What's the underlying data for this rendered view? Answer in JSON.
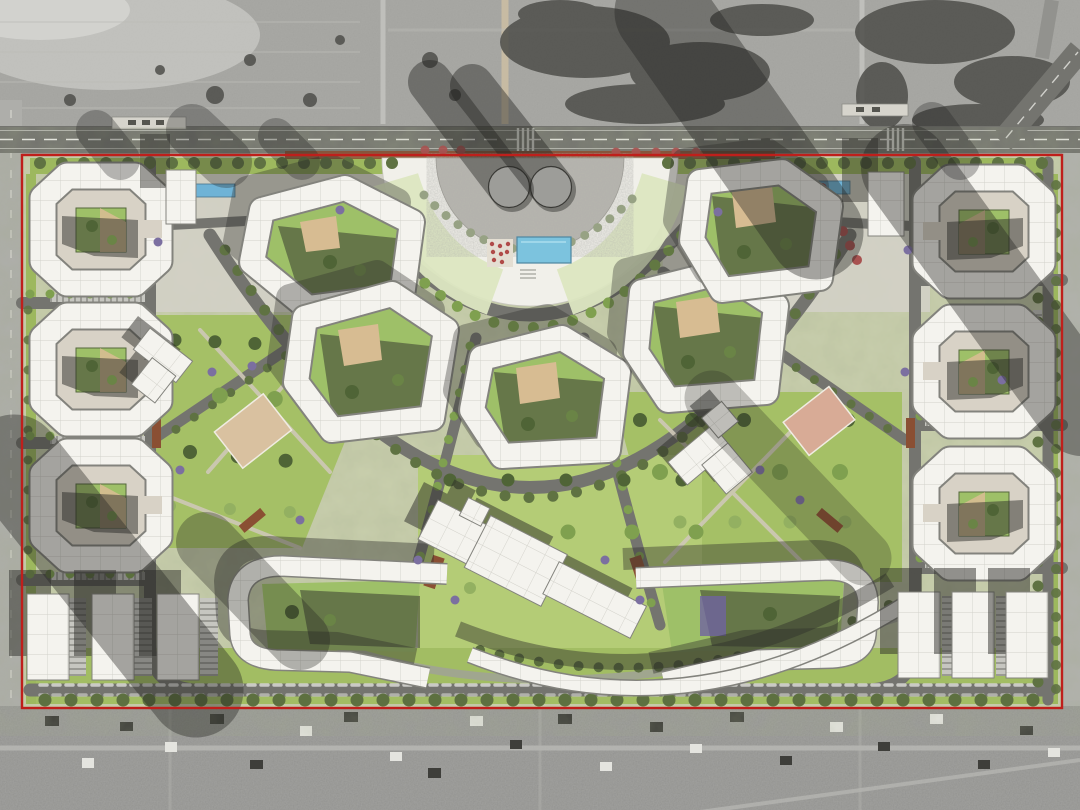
{
  "meta": {
    "image_type": "architectural-masterplan-render-over-satellite-photo",
    "description": "Aerial site plan of a residential district: semicircular central plaza with two round pavilions and a pool, fan of courtyard blocks, perimeter slab buildings, parks, red site boundary over grayscale satellite context",
    "interactive": false
  },
  "legend": {
    "site_boundary": "red outline rectangle",
    "residential_block": "white panelled roof courtyard building",
    "central_plaza": "semicircular white plaza with two circular pavilions and pool",
    "school": "rotated white volumes on central lawn",
    "parks": "bright green lawns with trees and sport courts",
    "roads": "gray asphalt with white dashed markings",
    "context": "grayscale satellite photo: fields above, village below"
  },
  "counts": {
    "round_pavilions": 2,
    "ring_courtyard_blocks": 5,
    "edge_courtyard_blocks": 6,
    "bottom_slab_buildings": 6,
    "bottom_angular_blocks": 2
  },
  "colors": {
    "satBase": "#9c9c99",
    "satLight": "#c9c9c5",
    "satDark": "#4e4e4a",
    "village": "#929290",
    "road": "#74746f",
    "roadMinor": "#a0a09a",
    "laneWhite": "#e9e9e4",
    "siteBase": "#c9cfad",
    "park": "#a5c066",
    "parkLight": "#b4cc76",
    "lawnPale": "#dce6c1",
    "paving": "#d3d0c6",
    "plazaWhite": "#f1f0ea",
    "plazaInner": "#b7b5ae",
    "building": "#f4f3ee",
    "panelLine": "#d2d1ca",
    "bldOutline": "#83837d",
    "courtPaving": "#d8d2c6",
    "courtLawn": "#9ec068",
    "sand": "#d7bc92",
    "shadow": "#2e2e2a",
    "treeOlive": "#5f7242",
    "treeGreen": "#7fa04f",
    "treeGray": "#97a284",
    "treeRed": "#a85250",
    "treePurple": "#7b6fa0",
    "hedge": "#55683c",
    "pool": "#7cc3de",
    "poolEdge": "#4e86a0",
    "canopy": "#6fb3d6",
    "terracotta": "#8a4f33",
    "sportCourt": "#d9c1a0",
    "boundary": "#bf1f1b",
    "parking": "#c6c6c0",
    "parkingLine": "#6e6e68"
  }
}
